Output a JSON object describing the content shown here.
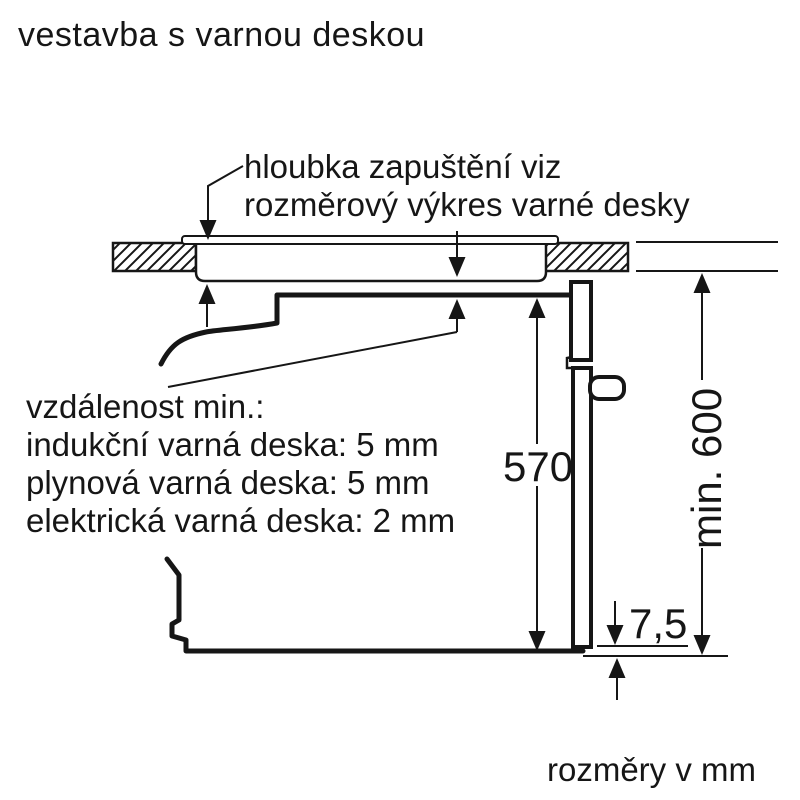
{
  "title": "vestavba s varnou deskou",
  "hob_note": {
    "line1": "hloubka zapuštění viz",
    "line2": "rozměrový výkres varné desky"
  },
  "clearance_note": {
    "heading": "vzdálenost min.:",
    "items": [
      "indukční varná deska: 5 mm",
      "plynová varná deska: 5 mm",
      "elektrická varná deska: 2 mm"
    ]
  },
  "dimensions": {
    "oven_height_mm": "570",
    "min_niche_height": "min. 600",
    "door_bottom_gap_mm": "7,5"
  },
  "footer_note": "rozměry v mm",
  "colors": {
    "line": "#161616",
    "background": "#ffffff"
  }
}
